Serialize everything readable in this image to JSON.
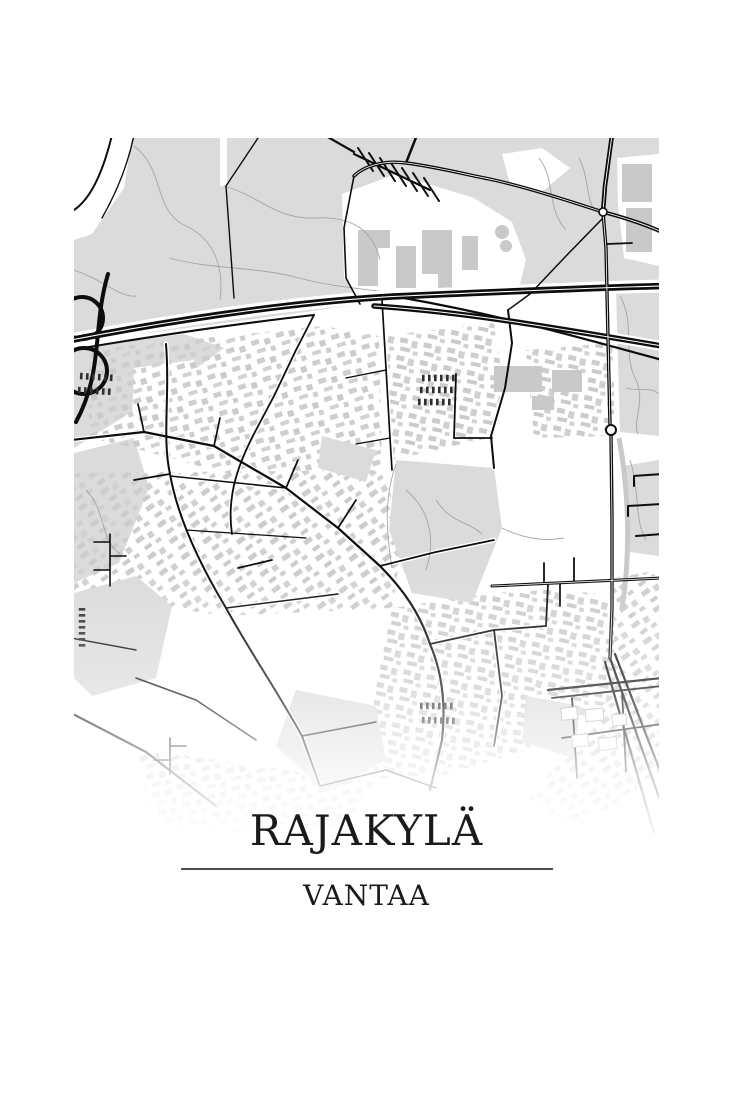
{
  "poster": {
    "title": "RAJAKYLÄ",
    "subtitle": "VANTAA",
    "style": "black-and-white minimalist city map print",
    "colors": {
      "background": "#ffffff",
      "forest": "#dbdbdb",
      "building": "#cbcbcb",
      "road": "#0d0d0d",
      "trail": "#a5a5a5",
      "text": "#1a1a1a",
      "divider": "#4d4d4d"
    }
  }
}
